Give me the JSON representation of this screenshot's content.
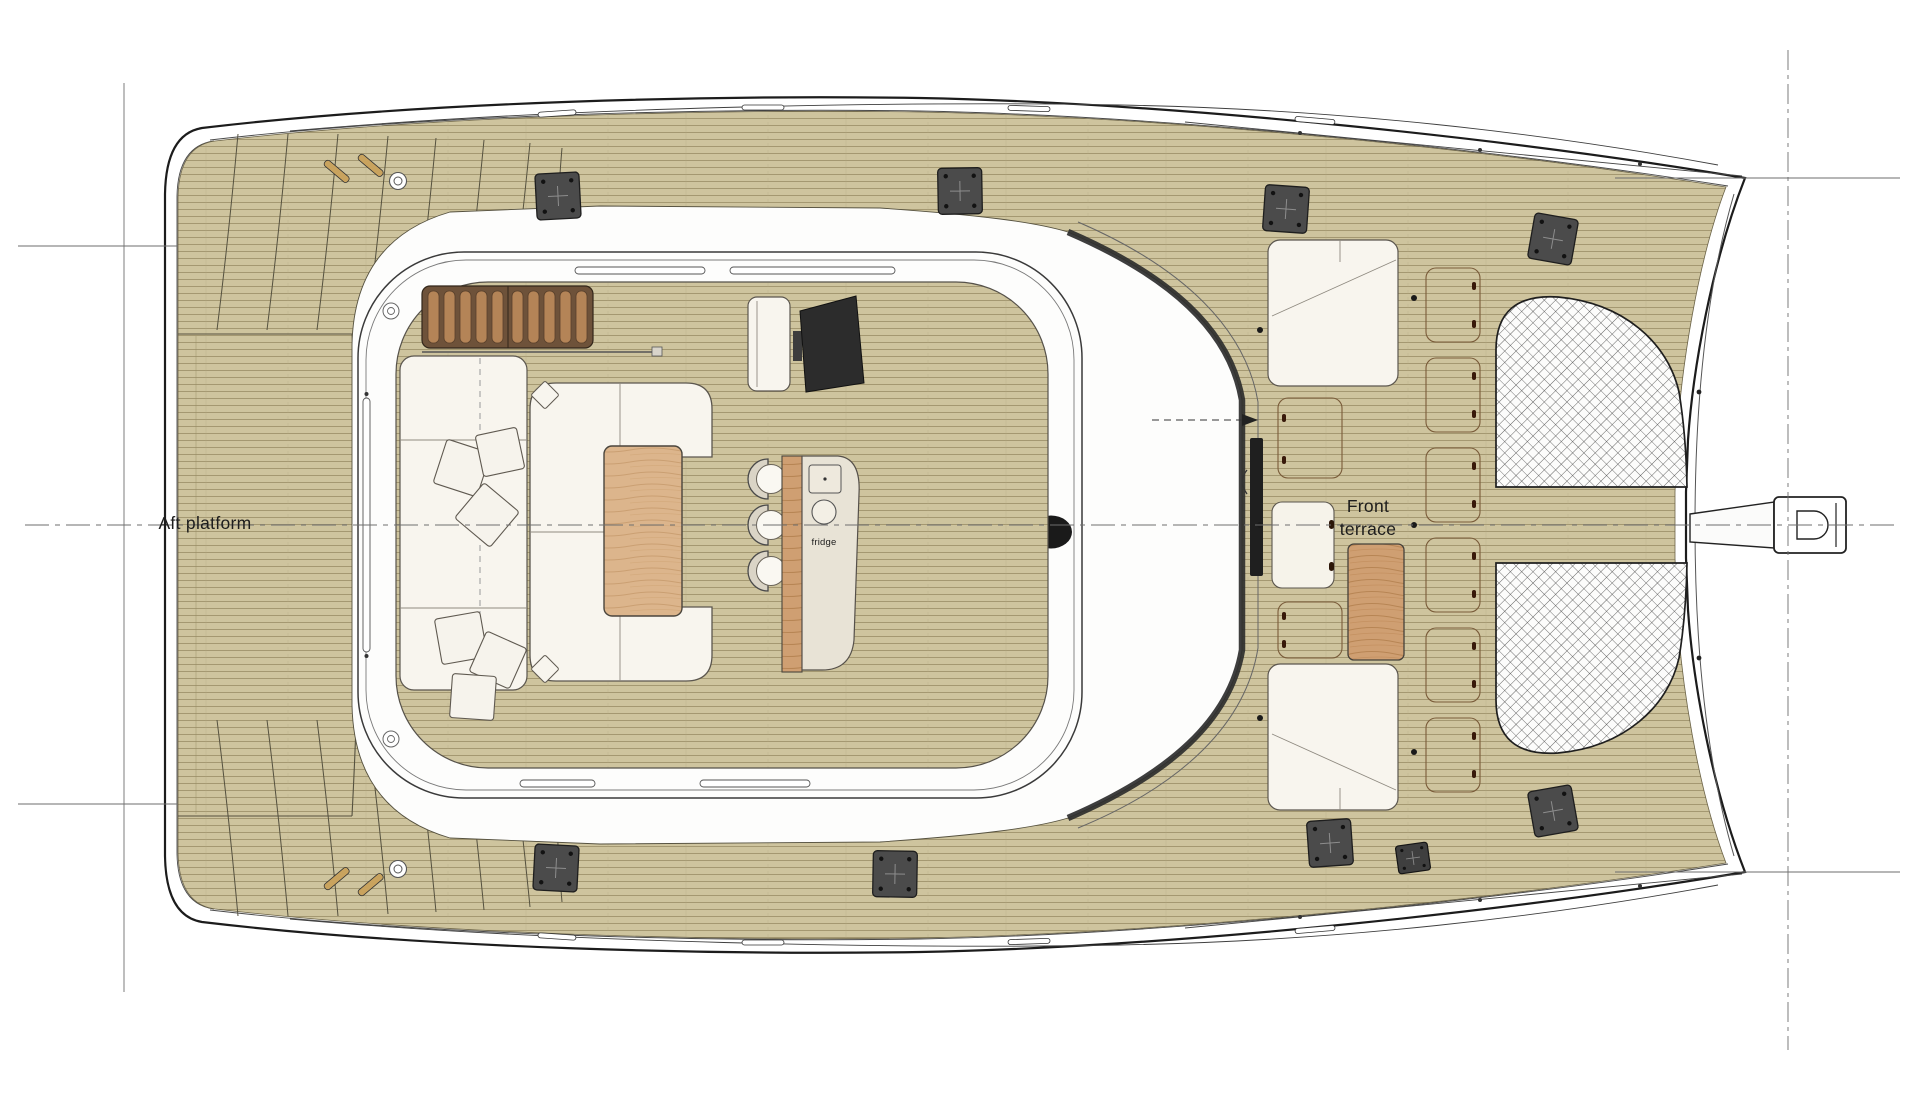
{
  "labels": {
    "aft_platform": "Aft platform",
    "front_terrace_line1": "Front",
    "front_terrace_line2": "terrace",
    "fridge": "fridge"
  },
  "colors": {
    "background": "#ffffff",
    "teak_deck": "#cec49e",
    "plank_line": "#958a61",
    "wood_table": "#d3a87e",
    "wood_table_light": "#dcb58c",
    "hull_outline": "#1c1c1c",
    "white_furniture": "#f8f5ee",
    "cleat_plate": "#4b4b4b",
    "net_line": "#4a4a4a",
    "hatch_outline": "#7a5c3a",
    "roof_band": "#2e2e2e",
    "roof_hatch": "#1a1a1a"
  }
}
